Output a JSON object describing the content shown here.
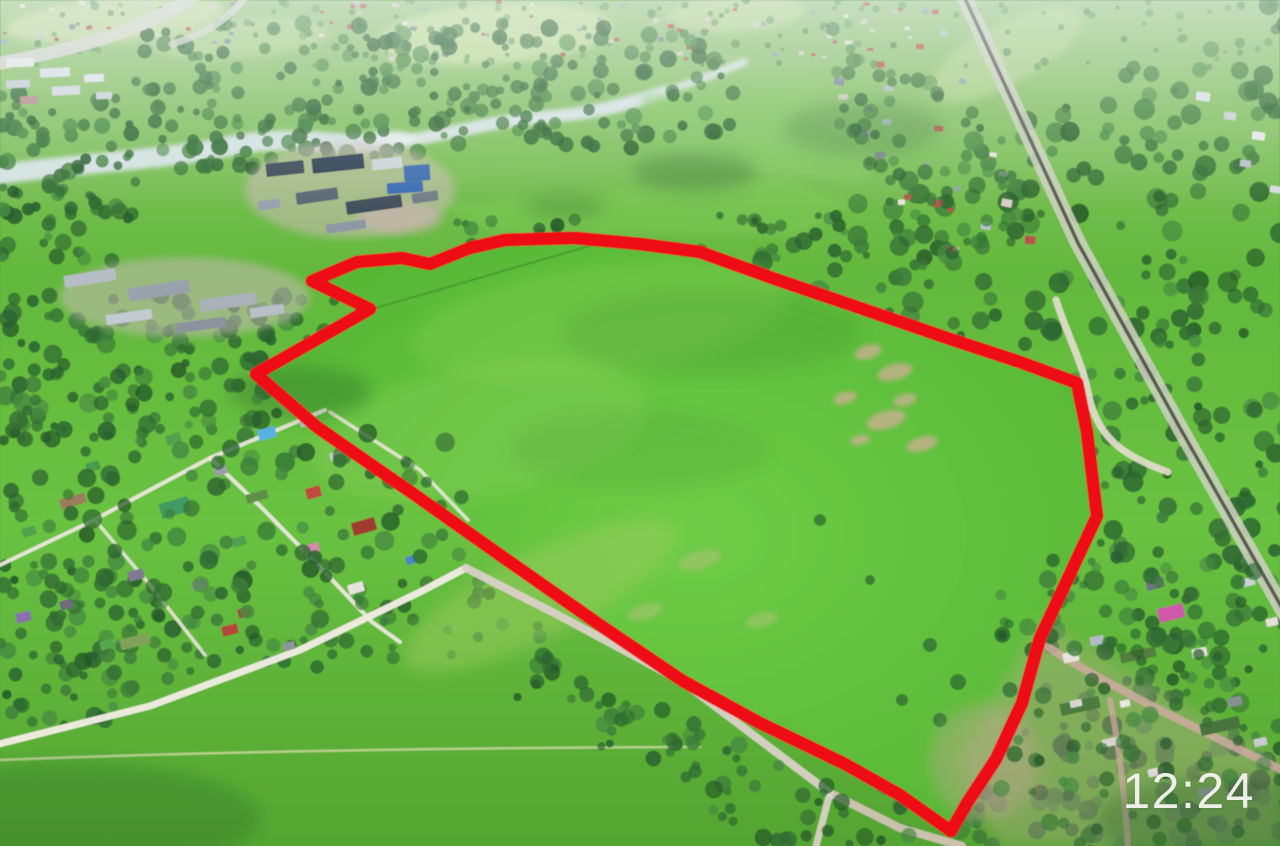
{
  "photo_overlay": {
    "timestamp": "12:24"
  },
  "colors": {
    "plot_outline_red": "#ee1016",
    "timestamp_white": "#f5f6f0"
  }
}
